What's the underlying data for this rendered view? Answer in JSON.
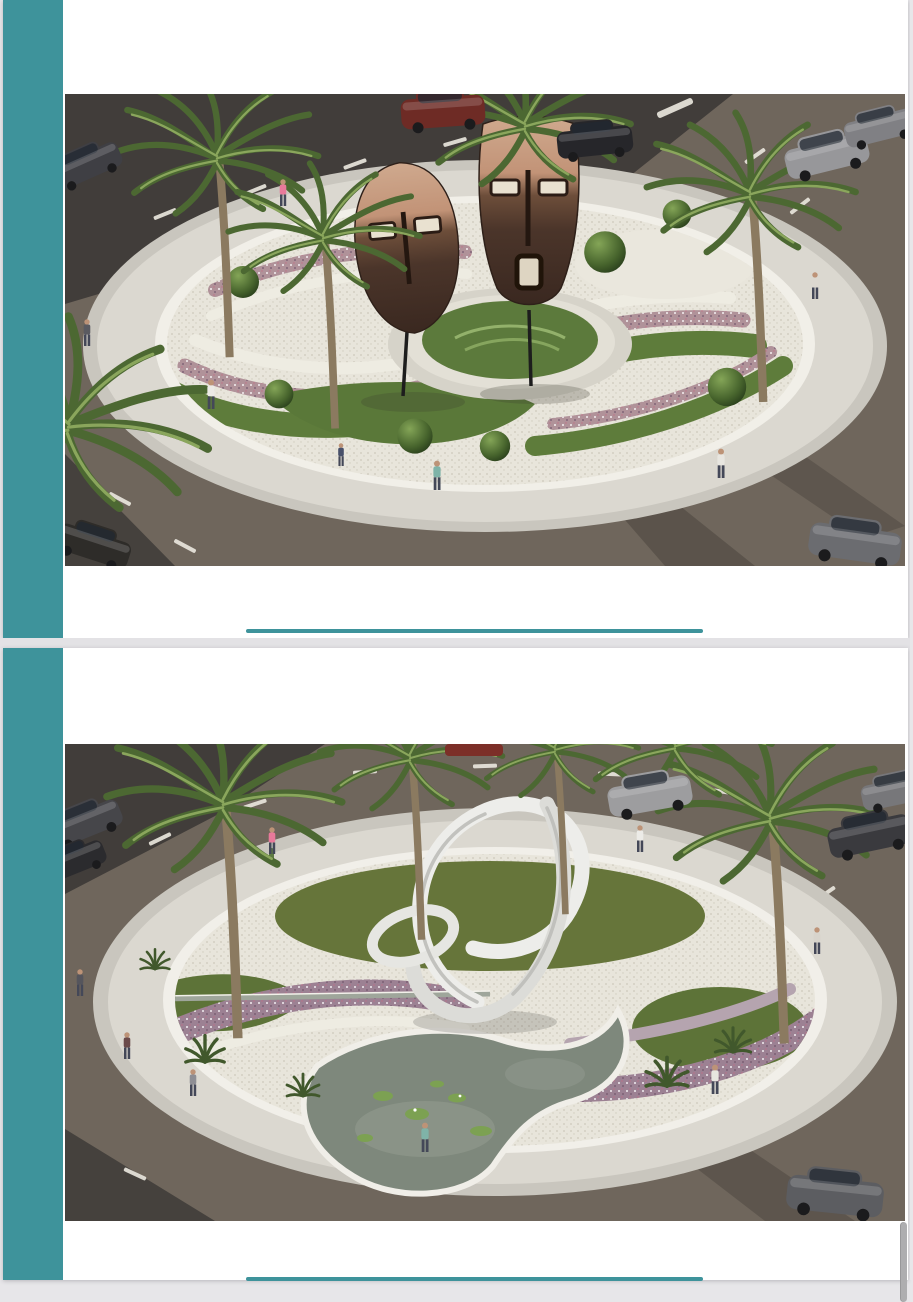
{
  "app": {
    "kind": "document viewer scrolled between two landscape-design slides",
    "visible_text": "none"
  },
  "colors": {
    "accent": "#3e939b",
    "window_bg": "#e7e6e9",
    "page_bg": "#ffffff",
    "separator": "#e3e2e5",
    "scrollbar": "#aeaeb0"
  },
  "artwork_palette": {
    "asphalt": "#413d3a",
    "road_aggregate": "#6f665c",
    "paving_ring": "#dbd8d0",
    "white_gravel": "#e8e5db",
    "grass": "#5d7a3c",
    "flower_band_pink": "#b09299",
    "flower_band_purple": "#9c8193",
    "pond_water": "#7e887c",
    "mask_wood_light": "#c9a58c",
    "mask_wood_dark": "#3f2c22",
    "sculpture_white": "#ededea",
    "lane_marking": "#e8e5dc"
  },
  "pages": [
    {
      "name": "page-1",
      "figure": {
        "id": "masks-roundabout-render",
        "description": "Aerial 3D render of a landscaped traffic roundabout with two carved wooden African mask sculptures on a central grass island, palm trees, round shrubs, curved bands of flowers and white gravel, encircling paved walkway and roads with cars and pedestrians"
      },
      "divider": "teal underline"
    },
    {
      "name": "page-2",
      "figure": {
        "id": "ribbon-roundabout-render",
        "description": "Aerial 3D render of a landscaped traffic roundabout with a white looping ribbon knot sculpture, a curved lily pond, purple flower bands, white gravel, palm trees and agaves, encircling paved walkway and roads with cars and pedestrians"
      },
      "divider": "teal underline"
    }
  ]
}
